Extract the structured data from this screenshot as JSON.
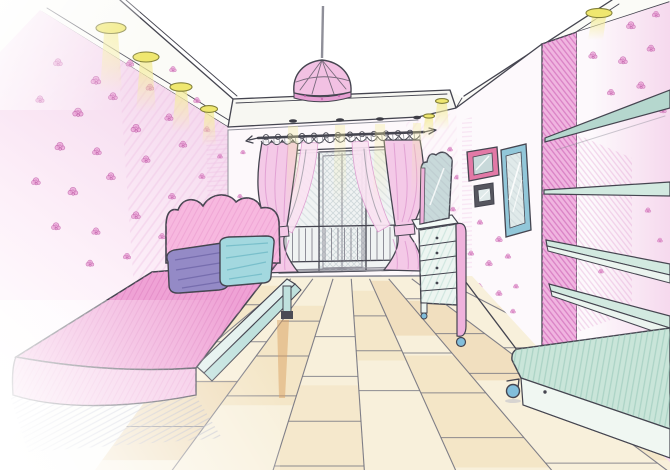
{
  "scene": {
    "title": "Hand-drawn interior design sketch of a girl's bedroom in pink, one-point perspective, colored pencil and ink",
    "style": "colored pencil and marker sketch on white paper",
    "objects": [
      {
        "name": "ceiling",
        "features": [
          "recessed dropped border",
          "seven round spotlights with yellow light beams",
          "soffit above window with four small downlights"
        ]
      },
      {
        "name": "pendant-lamp",
        "features": [
          "pink faceted dome shade",
          "thin rod"
        ]
      },
      {
        "name": "wallpaper",
        "pattern": "scattered pink roses on pale pink walls"
      },
      {
        "name": "window",
        "features": [
          "curtain rod with arrow finials and rings",
          "white lace scalloped valance",
          "two outer pink curtains tied at the waist",
          "two inner pink sheers crossing",
          "balcony door with cross-hatched glass",
          "balcony railing"
        ]
      },
      {
        "name": "bed",
        "features": [
          "scalloped pink headboard",
          "pink bedspread",
          "purple pillow",
          "teal pillow",
          "pale teal frame rail with leg"
        ]
      },
      {
        "name": "dresser",
        "features": [
          "four drawers",
          "round knobs",
          "pink corner stile",
          "caster feet",
          "leaning vanity mirror with wavy crown"
        ]
      },
      {
        "name": "wall-frames",
        "items": [
          "pink picture frame",
          "small dark frame",
          "tall blue mirror"
        ]
      },
      {
        "name": "pier",
        "features": [
          "pink hatched wall column reaching the ceiling"
        ]
      },
      {
        "name": "wall-shelves",
        "count": 4,
        "color": "pale teal"
      },
      {
        "name": "bench",
        "features": [
          "teal hatched top",
          "white front with knob",
          "blue caster wheel"
        ]
      },
      {
        "name": "floor",
        "material": "light wooden planks converging to a central vanishing point"
      }
    ]
  },
  "palette": {
    "paper": "#fbfbf7",
    "ink": "#454550",
    "softLine": "#8f8f99",
    "wallPink": "#f5d9ee",
    "wallHatch": "#eec3e4",
    "roseFill": "#eba4d7",
    "roseStroke": "#c05fa9",
    "ceilingWhite": "#ffffff",
    "spotFill": "#efe76f",
    "spotRim": "#83813a",
    "beam": "#f5ed9e",
    "curtain": "#f4c9e7",
    "curtainStroke": "#de9bd0",
    "sheer": "#fae3f2",
    "glass": "#f0f3f3",
    "glassHatch": "#b6c2c8",
    "headboard": "#f7b8df",
    "mattress": "#efa2d5",
    "mattressHatch": "#de82c0",
    "bedFront": "#f4c3e4",
    "skirtShadow": "#a6abc4",
    "pillowPurple": "#948ac6",
    "pillowPurpleDark": "#6c63a6",
    "pillowTeal": "#a3d8df",
    "pillowTealDark": "#6bb7c4",
    "railFace": "#e4f1ee",
    "railTeal": "#bfe1dd",
    "footDark": "#4b4b54",
    "tanStreak": "#d9a263",
    "dresserFace": "#edf5f1",
    "dresserHatch": "#b2d6cd",
    "dresserPink": "#efb2dc",
    "mirrorGlass": "#c8d9da",
    "framePink": "#e279a6",
    "frameDark": "#56565f",
    "frameBlue": "#92c7d9",
    "frameGlass": "#e0eaea",
    "pierPink": "#f0b5e0",
    "pierHatch": "#d26fbc",
    "shelfTop": "#d2e9e0",
    "shelfUnder": "#b5d7ce",
    "shelfEdge": "#ebf4ef",
    "benchTop": "#c9e5d9",
    "benchHatch": "#99c8b9",
    "benchFace": "#f0f7f2",
    "wheelBlue": "#82bedb",
    "floorBase": "#f8f0db",
    "floorBand": "#eed8a9",
    "floorTan": "#e1ba7f",
    "floorLine": "#73737f",
    "washPink": "#f1c3e4",
    "lampShade": "#f2c1e3",
    "lampRim": "#e69fd3"
  }
}
